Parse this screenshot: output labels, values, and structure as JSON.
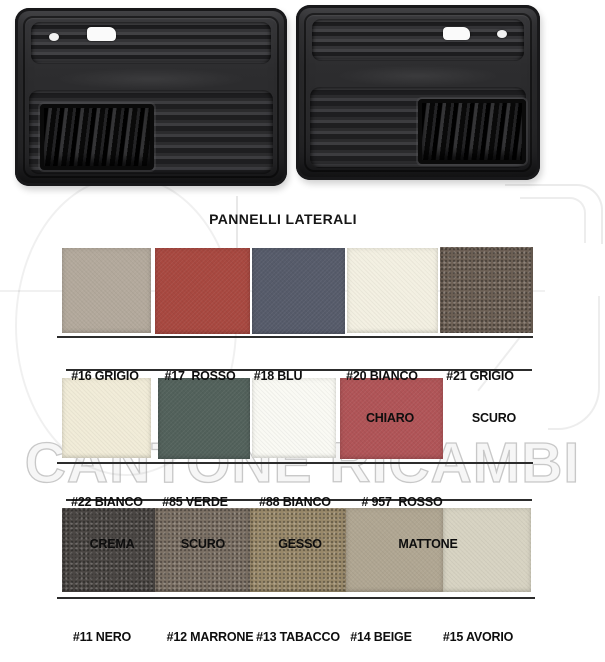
{
  "title": "PANNELLI LATERALI",
  "watermark": "CANTONE RICAMBI",
  "rows": [
    {
      "swatches": [
        {
          "code": "#16",
          "name": "GRIGIO",
          "color": "#b3a99c",
          "line1": "#16 GRIGIO",
          "line2": ""
        },
        {
          "code": "#17",
          "name": "ROSSO",
          "color": "#a84840",
          "line1": "#17  ROSSO",
          "line2": ""
        },
        {
          "code": "#18",
          "name": "BLU",
          "color": "#565b6a",
          "line1": "#18 BLU",
          "line2": ""
        },
        {
          "code": "#20",
          "name": "BIANCO CHIARO",
          "color": "#f3f0e2",
          "line1": "#20 BIANCO",
          "line2": "CHIARO"
        },
        {
          "code": "#21",
          "name": "GRIGIO SCURO",
          "color": "#6d6055",
          "line1": "#21 GRIGIO",
          "line2": "SCURO"
        }
      ]
    },
    {
      "swatches": [
        {
          "code": "#22",
          "name": "BIANCO CREMA",
          "color": "#f1ecd8",
          "line1": "#22 BIANCO",
          "line2": "CREMA"
        },
        {
          "code": "#85",
          "name": "VERDE SCURO",
          "color": "#52615b",
          "line1": "#85 VERDE",
          "line2": "SCURO"
        },
        {
          "code": "#88",
          "name": "BIANCO GESSO",
          "color": "#fafaf4",
          "line1": "#88 BIANCO",
          "line2": "GESSO"
        },
        {
          "code": "#957",
          "name": "ROSSO MATTONE",
          "color": "#b05457",
          "line1": "# 957  ROSSO",
          "line2": "MATTONE"
        }
      ]
    },
    {
      "swatches": [
        {
          "code": "#11",
          "name": "NERO",
          "color": "#4b4744",
          "line1": "#11 NERO",
          "line2": ""
        },
        {
          "code": "#12",
          "name": "MARRONE",
          "color": "#7b7064",
          "line1": "#12 MARRONE",
          "line2": ""
        },
        {
          "code": "#13",
          "name": "TABACCO",
          "color": "#99896a",
          "line1": "#13 TABACCO",
          "line2": ""
        },
        {
          "code": "#14",
          "name": "BEIGE",
          "color": "#b0a692",
          "line1": "#14 BEIGE",
          "line2": ""
        },
        {
          "code": "#15",
          "name": "AVORIO",
          "color": "#d7d3c2",
          "line1": "#15 AVORIO",
          "line2": ""
        }
      ]
    }
  ]
}
